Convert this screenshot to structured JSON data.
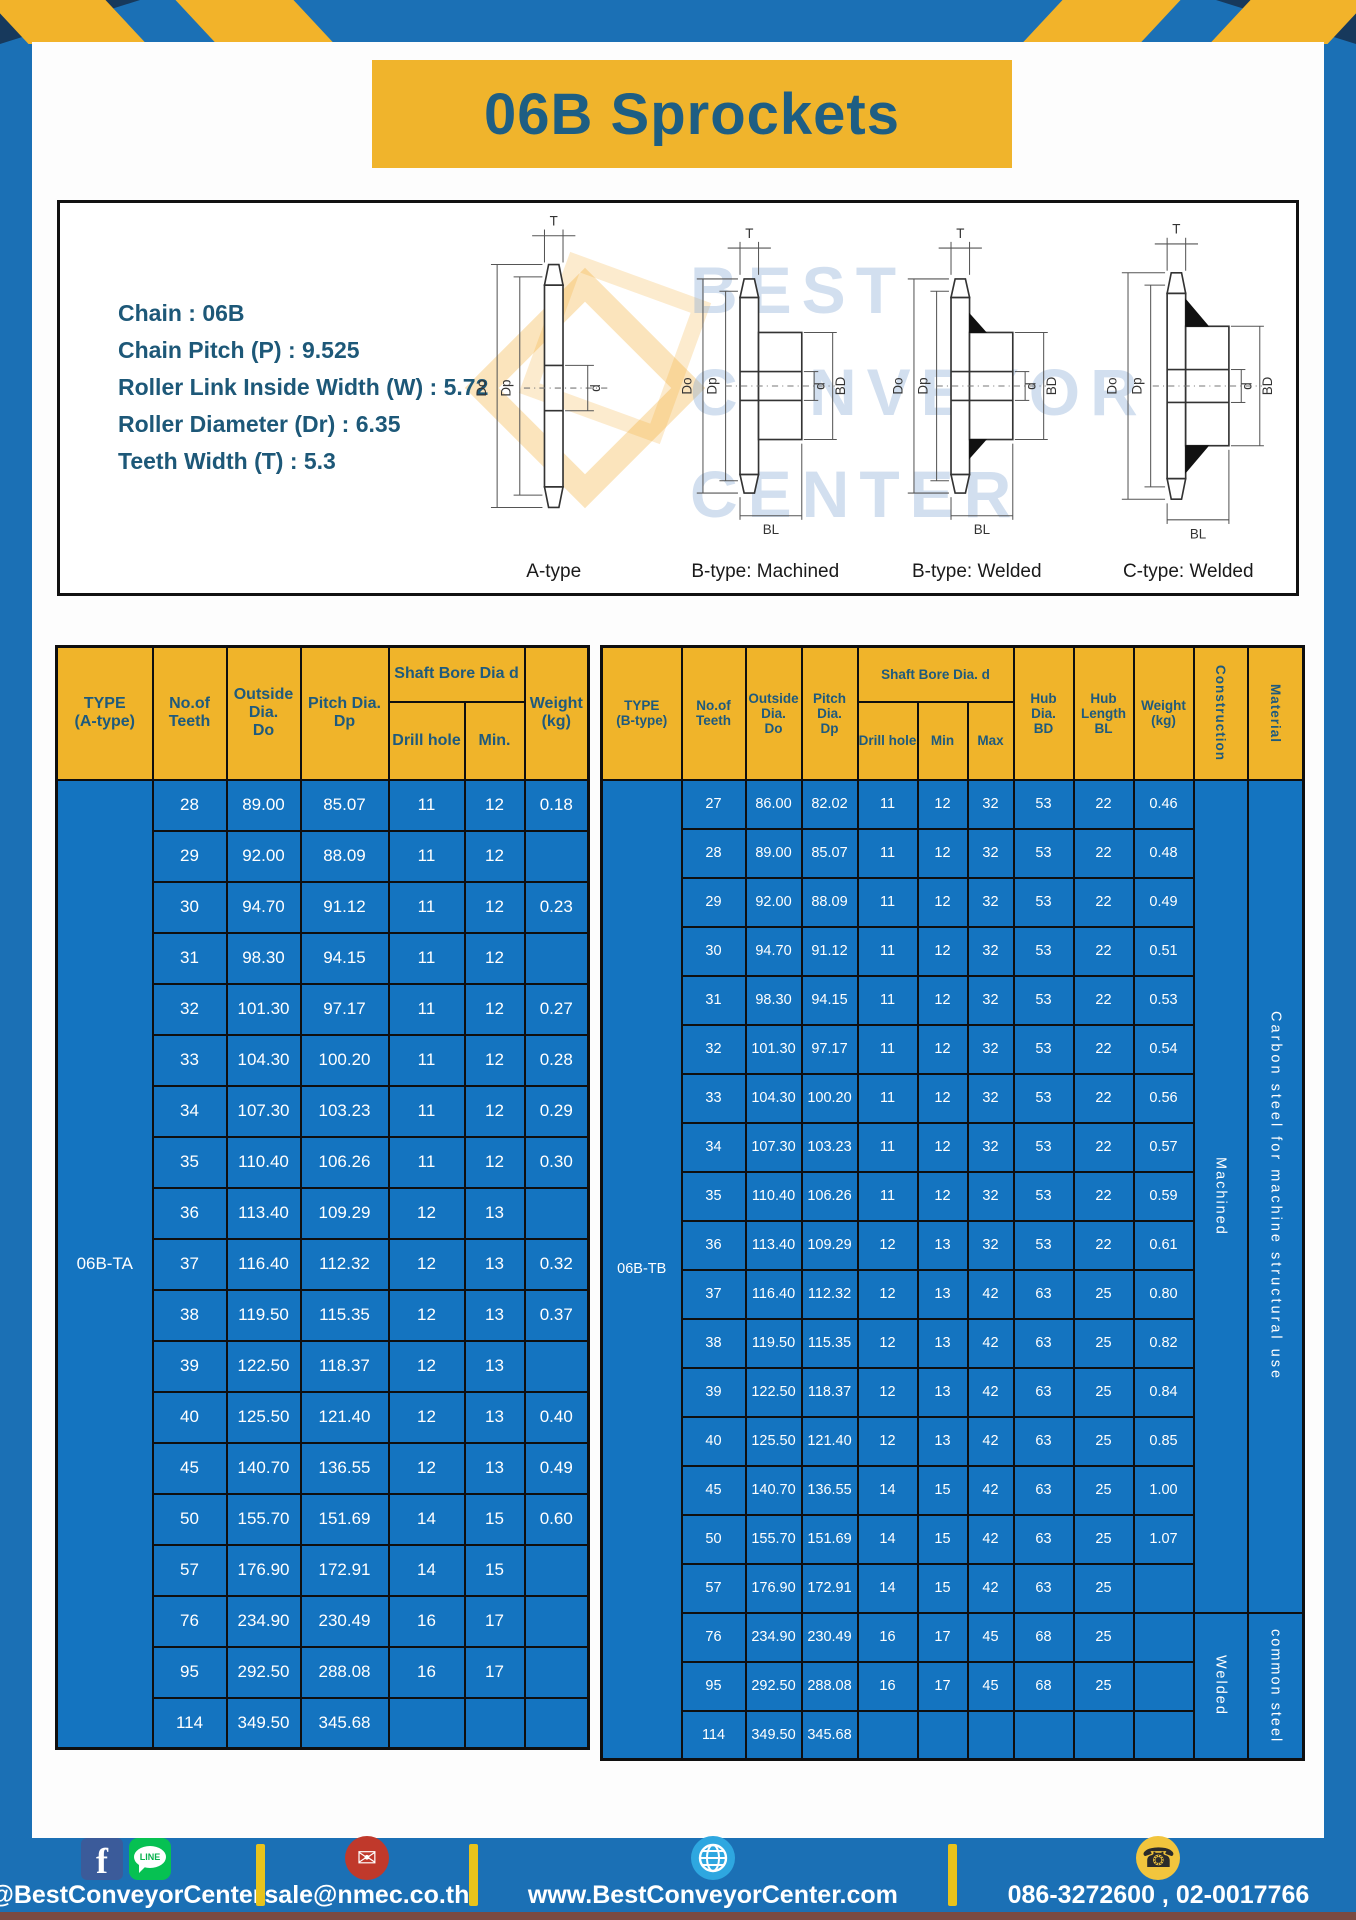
{
  "title_banner": {
    "text": "06B Sprockets"
  },
  "specs": {
    "lines": [
      "Chain : 06B",
      "Chain Pitch (P) : 9.525",
      "Roller Link Inside Width (W) : 5.72",
      "Roller Diameter (Dr) : 6.35",
      "Teeth Width (T) : 5.3"
    ]
  },
  "diagram": {
    "watermark": "BEST\nCONVEYOR\nCENTER",
    "dims": {
      "t": "T",
      "do": "Do",
      "dp": "Dp",
      "d": "d",
      "bd": "BD",
      "bl": "BL"
    },
    "types": {
      "a": "A-type",
      "b_machined": "B-type: Machined",
      "b_welded": "B-type: Welded",
      "c_welded": "C-type: Welded"
    }
  },
  "table_a": {
    "type_label": "06B-TA",
    "headers": {
      "type": "TYPE\n(A-type)",
      "teeth": "No.of\nTeeth",
      "outside": "Outside\nDia.\nDo",
      "pitch": "Pitch Dia.\nDp",
      "shaft_bore": "Shaft Bore Dia d",
      "drill": "Drill hole",
      "min": "Min.",
      "weight": "Weight\n(kg)"
    },
    "rows": [
      [
        "28",
        "89.00",
        "85.07",
        "11",
        "12",
        "0.18"
      ],
      [
        "29",
        "92.00",
        "88.09",
        "11",
        "12",
        ""
      ],
      [
        "30",
        "94.70",
        "91.12",
        "11",
        "12",
        "0.23"
      ],
      [
        "31",
        "98.30",
        "94.15",
        "11",
        "12",
        ""
      ],
      [
        "32",
        "101.30",
        "97.17",
        "11",
        "12",
        "0.27"
      ],
      [
        "33",
        "104.30",
        "100.20",
        "11",
        "12",
        "0.28"
      ],
      [
        "34",
        "107.30",
        "103.23",
        "11",
        "12",
        "0.29"
      ],
      [
        "35",
        "110.40",
        "106.26",
        "11",
        "12",
        "0.30"
      ],
      [
        "36",
        "113.40",
        "109.29",
        "12",
        "13",
        ""
      ],
      [
        "37",
        "116.40",
        "112.32",
        "12",
        "13",
        "0.32"
      ],
      [
        "38",
        "119.50",
        "115.35",
        "12",
        "13",
        "0.37"
      ],
      [
        "39",
        "122.50",
        "118.37",
        "12",
        "13",
        ""
      ],
      [
        "40",
        "125.50",
        "121.40",
        "12",
        "13",
        "0.40"
      ],
      [
        "45",
        "140.70",
        "136.55",
        "12",
        "13",
        "0.49"
      ],
      [
        "50",
        "155.70",
        "151.69",
        "14",
        "15",
        "0.60"
      ],
      [
        "57",
        "176.90",
        "172.91",
        "14",
        "15",
        ""
      ],
      [
        "76",
        "234.90",
        "230.49",
        "16",
        "17",
        ""
      ],
      [
        "95",
        "292.50",
        "288.08",
        "16",
        "17",
        ""
      ],
      [
        "114",
        "349.50",
        "345.68",
        "",
        "",
        ""
      ]
    ]
  },
  "table_b": {
    "type_label": "06B-TB",
    "headers": {
      "type": "TYPE\n(B-type)",
      "teeth": "No.of\nTeeth",
      "outside": "Outside\nDia.\nDo",
      "pitch": "Pitch\nDia.\nDp",
      "shaft_bore": "Shaft Bore Dia. d",
      "drill": "Drill hole",
      "min": "Min",
      "max": "Max",
      "hub_dia": "Hub\nDia.\nBD",
      "hub_len": "Hub\nLength\nBL",
      "weight": "Weight\n(kg)",
      "construction": "Construction",
      "material": "Material"
    },
    "construction_groups": [
      {
        "label": "Machined",
        "rows": 17
      },
      {
        "label": "Welded",
        "rows": 3
      }
    ],
    "material_groups": [
      {
        "label": "Carbon steel for machine structural use",
        "rows": 17
      },
      {
        "label": "common steel",
        "rows": 3
      }
    ],
    "rows": [
      [
        "27",
        "86.00",
        "82.02",
        "11",
        "12",
        "32",
        "53",
        "22",
        "0.46"
      ],
      [
        "28",
        "89.00",
        "85.07",
        "11",
        "12",
        "32",
        "53",
        "22",
        "0.48"
      ],
      [
        "29",
        "92.00",
        "88.09",
        "11",
        "12",
        "32",
        "53",
        "22",
        "0.49"
      ],
      [
        "30",
        "94.70",
        "91.12",
        "11",
        "12",
        "32",
        "53",
        "22",
        "0.51"
      ],
      [
        "31",
        "98.30",
        "94.15",
        "11",
        "12",
        "32",
        "53",
        "22",
        "0.53"
      ],
      [
        "32",
        "101.30",
        "97.17",
        "11",
        "12",
        "32",
        "53",
        "22",
        "0.54"
      ],
      [
        "33",
        "104.30",
        "100.20",
        "11",
        "12",
        "32",
        "53",
        "22",
        "0.56"
      ],
      [
        "34",
        "107.30",
        "103.23",
        "11",
        "12",
        "32",
        "53",
        "22",
        "0.57"
      ],
      [
        "35",
        "110.40",
        "106.26",
        "11",
        "12",
        "32",
        "53",
        "22",
        "0.59"
      ],
      [
        "36",
        "113.40",
        "109.29",
        "12",
        "13",
        "32",
        "53",
        "22",
        "0.61"
      ],
      [
        "37",
        "116.40",
        "112.32",
        "12",
        "13",
        "42",
        "63",
        "25",
        "0.80"
      ],
      [
        "38",
        "119.50",
        "115.35",
        "12",
        "13",
        "42",
        "63",
        "25",
        "0.82"
      ],
      [
        "39",
        "122.50",
        "118.37",
        "12",
        "13",
        "42",
        "63",
        "25",
        "0.84"
      ],
      [
        "40",
        "125.50",
        "121.40",
        "12",
        "13",
        "42",
        "63",
        "25",
        "0.85"
      ],
      [
        "45",
        "140.70",
        "136.55",
        "14",
        "15",
        "42",
        "63",
        "25",
        "1.00"
      ],
      [
        "50",
        "155.70",
        "151.69",
        "14",
        "15",
        "42",
        "63",
        "25",
        "1.07"
      ],
      [
        "57",
        "176.90",
        "172.91",
        "14",
        "15",
        "42",
        "63",
        "25",
        ""
      ],
      [
        "76",
        "234.90",
        "230.49",
        "16",
        "17",
        "45",
        "68",
        "25",
        ""
      ],
      [
        "95",
        "292.50",
        "288.08",
        "16",
        "17",
        "45",
        "68",
        "25",
        ""
      ],
      [
        "114",
        "349.50",
        "345.68",
        "",
        "",
        "",
        "",
        "",
        ""
      ]
    ]
  },
  "footer": {
    "social_label": "@BestConveyorCenter",
    "line_badge": "LINE",
    "fb_letter": "f",
    "mail_glyph": "✉",
    "phone_glyph": "☎",
    "email": "sale@nmec.co.th",
    "website": "www.BestConveyorCenter.com",
    "phones": "086-3272600 , 02-0017766"
  },
  "colors": {
    "accent_yellow": "#f0b42c",
    "main_blue": "#1b70b5",
    "cell_blue": "#1474c0",
    "corner_navy": "#17395c",
    "heading_teal": "#1e5e83"
  }
}
